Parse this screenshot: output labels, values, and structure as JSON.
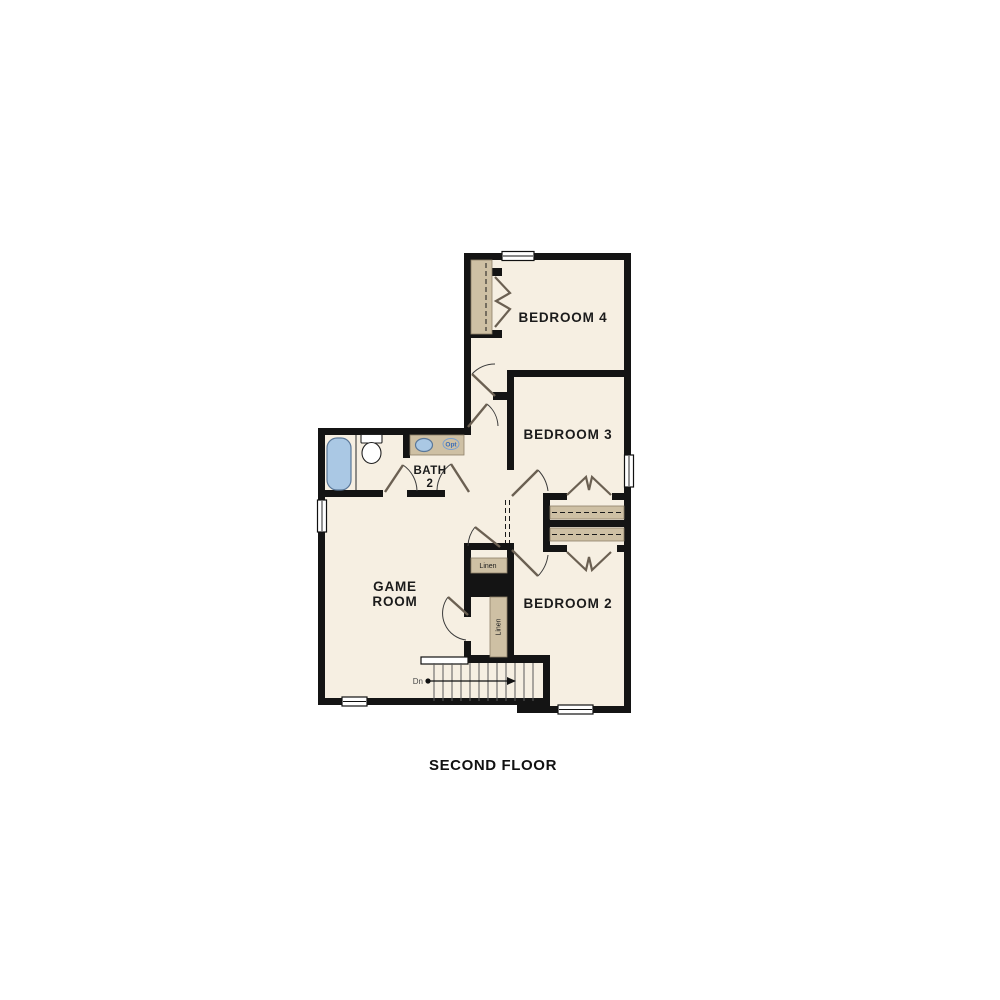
{
  "plan": {
    "title": "SECOND FLOOR",
    "rooms": {
      "bedroom4": {
        "label": "BEDROOM 4"
      },
      "bedroom3": {
        "label": "BEDROOM 3"
      },
      "bedroom2": {
        "label": "BEDROOM 2"
      },
      "game_room": {
        "label_line1": "GAME",
        "label_line2": "ROOM"
      },
      "bath2": {
        "label_line1": "BATH",
        "label_line2": "2"
      }
    },
    "closets": {
      "linen_upper": {
        "label": "Linen"
      },
      "linen_lower": {
        "label": "Linen"
      }
    },
    "stairs": {
      "direction_label": "Dn"
    },
    "vanity": {
      "opt_label": "Opt"
    },
    "colors": {
      "wall": "#141414",
      "floor": "#f6efe2",
      "closet_shelf": "#cec0a4",
      "fixture_blue": "#aac8e4",
      "door_leaf": "#6b6052",
      "page_background": "#ffffff"
    }
  }
}
